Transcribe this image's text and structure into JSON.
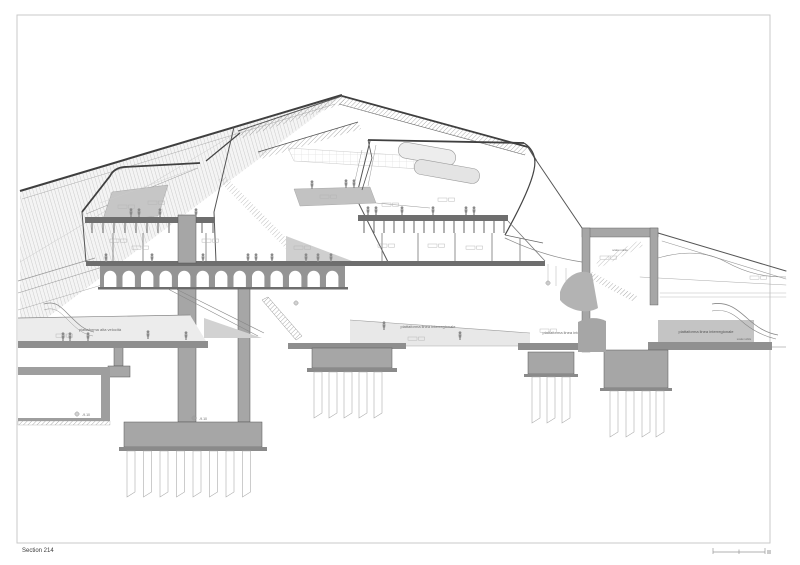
{
  "sheet": {
    "title": "Section 214",
    "kind": "architectural-cross-section"
  },
  "labels": {
    "section_title": "Section 214",
    "platform_high_speed": "piattaforma alta velocità",
    "platform_interregional_center": "piattaforma linea interregionale",
    "platform_interregional_mid": "piattaforma linea interregionale",
    "platform_interregional_right": "piattaforma linea interregionale",
    "escalator_core": "scala mobile",
    "escalator_right": "scala mobile",
    "level_tunnel": "-9.10",
    "level_foundation": "-9.10"
  },
  "colors": {
    "line_dark": "#3f3f3f",
    "poche": "#a6a6a6",
    "slab_dark": "#6e6e6e",
    "arcade_gray": "#949494",
    "platform_gray": "#c4c4c4",
    "platform_light": "#ececec",
    "mezzanine_gray": "#c2c2c2",
    "frame": "#c9c9c9",
    "people": "#8a8a8a"
  }
}
